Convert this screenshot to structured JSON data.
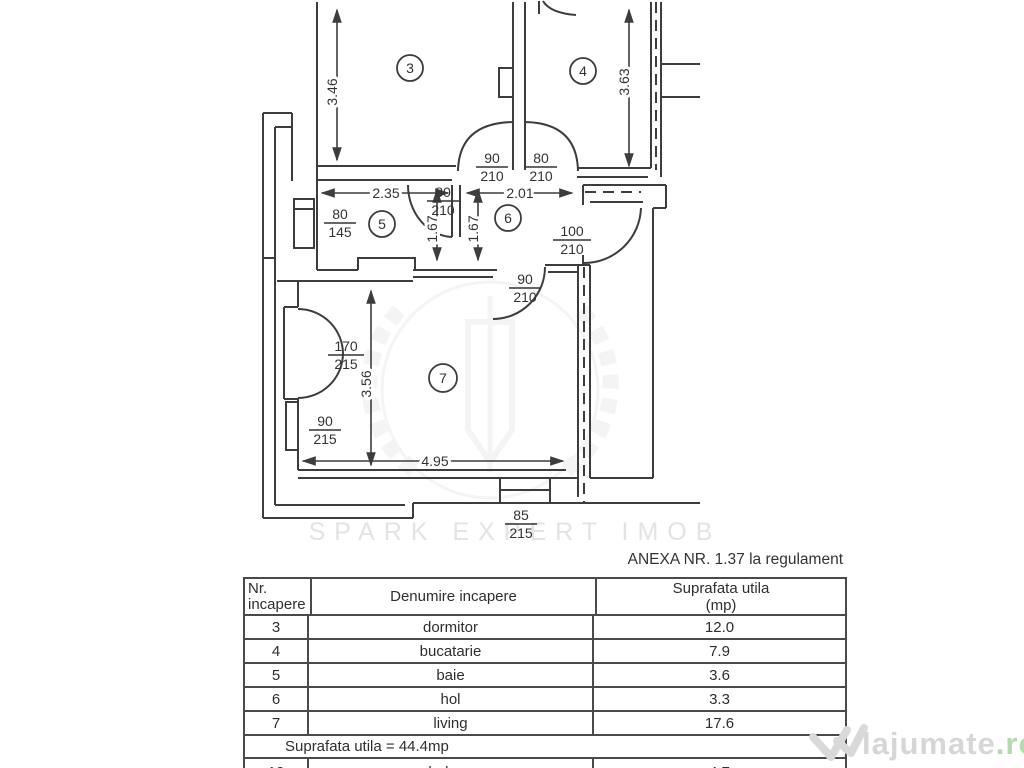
{
  "annex_note": "ANEXA NR. 1.37 la regulament",
  "plan": {
    "rooms": [
      {
        "n": "3"
      },
      {
        "n": "4"
      },
      {
        "n": "5"
      },
      {
        "n": "6"
      },
      {
        "n": "7"
      }
    ],
    "dims": [
      "3.46",
      "3.63",
      "2.35",
      "2.01",
      "1.67",
      "1.67",
      "3.56",
      "4.95"
    ],
    "doors": [
      {
        "num": "90",
        "den": "210"
      },
      {
        "num": "80",
        "den": "210"
      },
      {
        "num": "80",
        "den": "145"
      },
      {
        "num": "80",
        "den": "210"
      },
      {
        "num": "100",
        "den": "210"
      },
      {
        "num": "90",
        "den": "210"
      },
      {
        "num": "170",
        "den": "215"
      },
      {
        "num": "90",
        "den": "215"
      },
      {
        "num": "85",
        "den": "215"
      }
    ]
  },
  "table": {
    "headers": {
      "col1_line1": "Nr.",
      "col1_line2": "incapere",
      "col2": "Denumire incapere",
      "col3_line1": "Suprafata utila",
      "col3_line2": "(mp)"
    },
    "rows": [
      {
        "nr": "3",
        "name": "dormitor",
        "area": "12.0"
      },
      {
        "nr": "4",
        "name": "bucatarie",
        "area": "7.9"
      },
      {
        "nr": "5",
        "name": "baie",
        "area": "3.6"
      },
      {
        "nr": "6",
        "name": "hol",
        "area": "3.3"
      },
      {
        "nr": "7",
        "name": "living",
        "area": "17.6"
      }
    ],
    "total": "Suprafata utila = 44.4mp",
    "partial_row": {
      "nr": "12",
      "name": "balcon",
      "area": "4.7"
    }
  },
  "watermarks": {
    "agency": "SPARK EXPERT IMOB",
    "site": "lajumate",
    "site_tld": ".ro"
  }
}
